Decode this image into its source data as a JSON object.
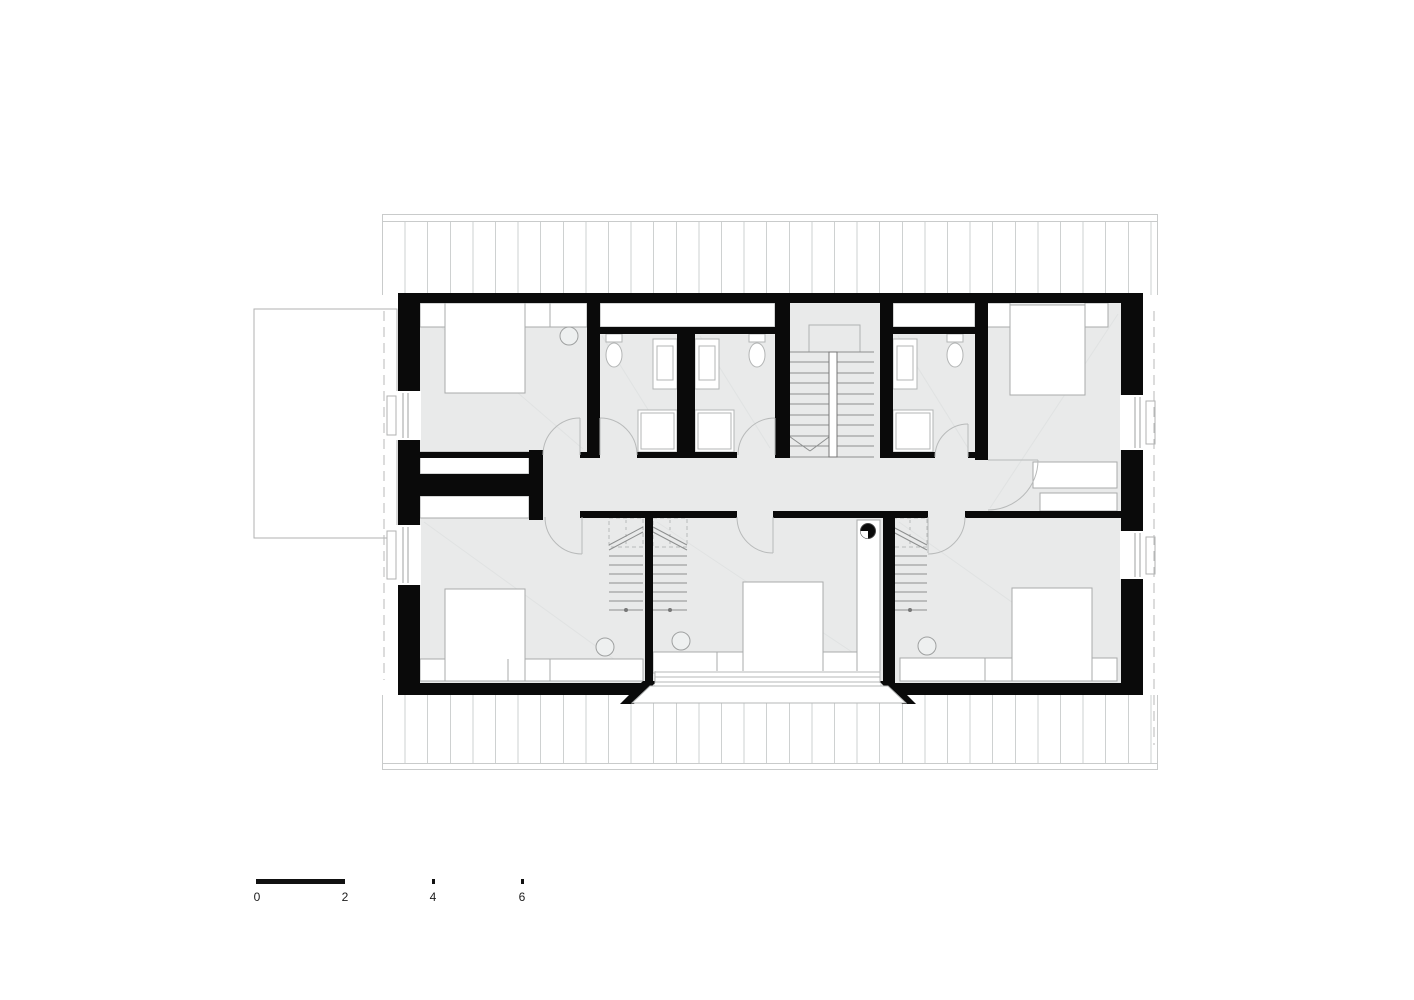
{
  "scale_bar": {
    "labels": [
      "0",
      "2",
      "4",
      "6"
    ]
  },
  "colors": {
    "wall": "#0a0a0a",
    "floor_fill": "#e9eaea",
    "roof_line": "#c9cbcb",
    "furniture_outline": "#a9abab",
    "door_swing": "#b8baba",
    "stair_line": "#8d8f8f",
    "scale_bar": "#111111"
  }
}
